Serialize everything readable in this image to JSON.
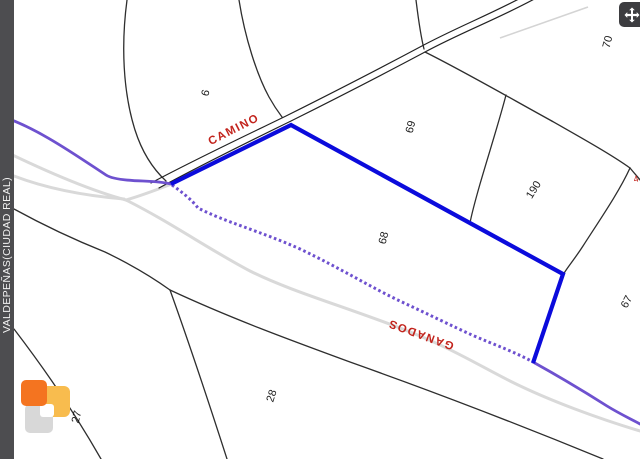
{
  "window": {
    "width": 640,
    "height": 459
  },
  "sidebar": {
    "region_label": "VALDEPEÑAS(CIUDAD REAL)"
  },
  "map": {
    "parcel_labels": [
      {
        "id": "6",
        "text": "6",
        "x": 206,
        "y": 93,
        "rot": -75
      },
      {
        "id": "69",
        "text": "69",
        "x": 411,
        "y": 127,
        "rot": -75
      },
      {
        "id": "68",
        "text": "68",
        "x": 384,
        "y": 238,
        "rot": -75
      },
      {
        "id": "190",
        "text": "190",
        "x": 534,
        "y": 190,
        "rot": -58
      },
      {
        "id": "70",
        "text": "70",
        "x": 608,
        "y": 42,
        "rot": -75
      },
      {
        "id": "67",
        "text": "67",
        "x": 627,
        "y": 302,
        "rot": -62
      },
      {
        "id": "28",
        "text": "28",
        "x": 272,
        "y": 396,
        "rot": -72
      },
      {
        "id": "27",
        "text": "27",
        "x": 77,
        "y": 417,
        "rot": -75
      }
    ],
    "road_labels": [
      {
        "id": "camino",
        "text": "CAMINO",
        "x": 234,
        "y": 130,
        "rot": -27
      },
      {
        "id": "ganados",
        "text": "GANADOS",
        "x": 421,
        "y": 334,
        "rot": 200
      }
    ],
    "annotation_labels": [
      {
        "id": "edge-4",
        "text": "4",
        "x": 636,
        "y": 179,
        "rot": -15
      }
    ]
  },
  "colors": {
    "selection_blue": "#0b0bdc",
    "route_purple": "#6e51cf",
    "road_gray": "#d9d9d9",
    "boundary_black": "#2e2e2e",
    "road_label_red": "#c2231c",
    "sidebar_gray": "#4d4d50",
    "logo_orange": "#f47420",
    "logo_amber": "#f8bc4e",
    "logo_gray": "#d8d8d8"
  }
}
